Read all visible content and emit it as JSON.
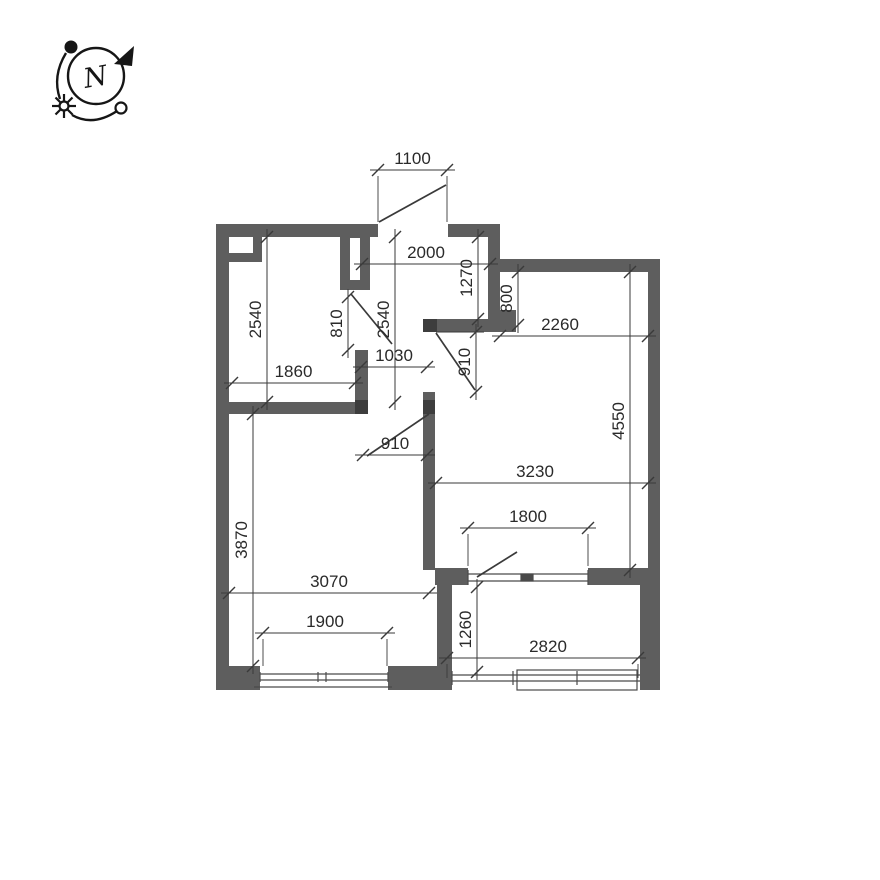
{
  "colors": {
    "background": "#ffffff",
    "wall": "#5e5e5e",
    "jamb": "#3d3d3d",
    "line": "#3a3a3a",
    "window_line": "#4a4a4a",
    "text": "#2a2a2a",
    "compass": "#161616"
  },
  "compass": {
    "label": "N"
  },
  "plan": {
    "walls": [
      {
        "x": 216,
        "y": 224,
        "w": 13,
        "h": 466
      },
      {
        "x": 216,
        "y": 224,
        "w": 162,
        "h": 13
      },
      {
        "x": 448,
        "y": 224,
        "w": 52,
        "h": 13
      },
      {
        "x": 488,
        "y": 237,
        "w": 12,
        "h": 88
      },
      {
        "x": 500,
        "y": 259,
        "w": 160,
        "h": 13
      },
      {
        "x": 648,
        "y": 259,
        "w": 12,
        "h": 431
      },
      {
        "x": 229,
        "y": 237,
        "w": 33,
        "h": 25
      },
      {
        "x": 340,
        "y": 237,
        "w": 30,
        "h": 53
      },
      {
        "x": 355,
        "y": 350,
        "w": 13,
        "h": 64
      },
      {
        "x": 216,
        "y": 402,
        "w": 152,
        "h": 12
      },
      {
        "x": 423,
        "y": 319,
        "w": 93,
        "h": 13
      },
      {
        "x": 500,
        "y": 310,
        "w": 16,
        "h": 9
      },
      {
        "x": 423,
        "y": 392,
        "w": 12,
        "h": 178
      },
      {
        "x": 435,
        "y": 568,
        "w": 33,
        "h": 17
      },
      {
        "x": 588,
        "y": 568,
        "w": 72,
        "h": 17
      },
      {
        "x": 437,
        "y": 585,
        "w": 15,
        "h": 93
      },
      {
        "x": 216,
        "y": 666,
        "w": 236,
        "h": 24
      },
      {
        "x": 640,
        "y": 585,
        "w": 20,
        "h": 105
      }
    ],
    "overlays": [
      {
        "x": 229,
        "y": 237,
        "w": 24,
        "h": 16
      },
      {
        "x": 350,
        "y": 238,
        "w": 10,
        "h": 42
      },
      {
        "x": 260,
        "y": 666,
        "w": 128,
        "h": 24
      }
    ],
    "jambs": [
      {
        "x": 355,
        "y": 400,
        "w": 13,
        "h": 14
      },
      {
        "x": 423,
        "y": 400,
        "w": 12,
        "h": 14
      },
      {
        "x": 423,
        "y": 319,
        "w": 14,
        "h": 13
      }
    ],
    "doors": [
      {
        "name": "entry-door-leaf",
        "line": [
          379,
          222,
          446,
          185
        ]
      },
      {
        "name": "bathroom-door-leaf",
        "line": [
          351,
          294,
          392,
          344
        ]
      },
      {
        "name": "living-room-door-leaf",
        "line": [
          436,
          333,
          475,
          390
        ]
      },
      {
        "name": "bedroom-door-leaf",
        "line": [
          367,
          456,
          429,
          414
        ]
      },
      {
        "name": "balcony-door-leaf",
        "line": [
          477,
          577,
          517,
          552
        ]
      }
    ],
    "windows": [
      {
        "name": "bedroom-window",
        "t": "l",
        "c": [
          260,
          674,
          388,
          674
        ]
      },
      {
        "name": "bedroom-window",
        "t": "l",
        "c": [
          260,
          680,
          388,
          680
        ]
      },
      {
        "name": "bedroom-window",
        "t": "l",
        "c": [
          260,
          672,
          260,
          682
        ]
      },
      {
        "name": "bedroom-window",
        "t": "l",
        "c": [
          388,
          672,
          388,
          682
        ]
      },
      {
        "name": "bedroom-window-mullion",
        "t": "l",
        "c": [
          318,
          672,
          318,
          682
        ]
      },
      {
        "name": "bedroom-window-mullion",
        "t": "l",
        "c": [
          326,
          672,
          326,
          682
        ]
      },
      {
        "name": "bedroom-window-sill",
        "t": "l",
        "c": [
          254,
          687,
          392,
          687
        ]
      },
      {
        "name": "balcony-glazing",
        "t": "l",
        "c": [
          452,
          675,
          640,
          675
        ]
      },
      {
        "name": "balcony-glazing",
        "t": "l",
        "c": [
          452,
          681,
          640,
          681
        ]
      },
      {
        "name": "balcony-glazing",
        "t": "l",
        "c": [
          452,
          671,
          452,
          685
        ]
      },
      {
        "name": "balcony-glazing-mullion",
        "t": "l",
        "c": [
          513,
          671,
          513,
          685
        ]
      },
      {
        "name": "balcony-glazing-mullion",
        "t": "l",
        "c": [
          577,
          671,
          577,
          685
        ]
      },
      {
        "name": "balcony-glazing-frame",
        "t": "r",
        "c": [
          517,
          670,
          120,
          20
        ]
      },
      {
        "name": "balcony-door-unit",
        "t": "l",
        "c": [
          468,
          574,
          588,
          574
        ]
      },
      {
        "name": "balcony-door-unit",
        "t": "l",
        "c": [
          468,
          581,
          588,
          581
        ]
      },
      {
        "name": "balcony-door-unit",
        "t": "l",
        "c": [
          468,
          570,
          468,
          585
        ]
      },
      {
        "name": "balcony-door-unit",
        "t": "l",
        "c": [
          588,
          570,
          588,
          585
        ]
      },
      {
        "name": "balcony-door-unit-mullion",
        "t": "r",
        "c": [
          521,
          574,
          12,
          7
        ],
        "f": true
      }
    ],
    "dims": [
      {
        "v": "1100",
        "d": "h",
        "a": 378,
        "b": 447,
        "p": 170,
        "ext": [
          [
            378,
            176,
            378,
            222
          ],
          [
            447,
            176,
            447,
            222
          ]
        ]
      },
      {
        "v": "2000",
        "d": "h",
        "a": 362,
        "b": 490,
        "p": 264
      },
      {
        "v": "2540",
        "d": "v",
        "a": 237,
        "b": 402,
        "p": 267
      },
      {
        "v": "1860",
        "d": "h",
        "a": 232,
        "b": 355,
        "p": 383
      },
      {
        "v": "810",
        "d": "v",
        "a": 297,
        "b": 350,
        "p": 348
      },
      {
        "v": "2540",
        "d": "v",
        "a": 237,
        "b": 402,
        "p": 395
      },
      {
        "v": "1030",
        "d": "h",
        "a": 361,
        "b": 427,
        "p": 367
      },
      {
        "v": "1270",
        "d": "v",
        "a": 237,
        "b": 319,
        "p": 478
      },
      {
        "v": "800",
        "d": "v",
        "a": 272,
        "b": 325,
        "p": 518
      },
      {
        "v": "2260",
        "d": "h",
        "a": 500,
        "b": 648,
        "p": 336,
        "tx": 560
      },
      {
        "v": "910",
        "d": "v",
        "a": 332,
        "b": 392,
        "p": 476,
        "ext": [
          [
            436,
            332,
            484,
            332
          ]
        ]
      },
      {
        "v": "4550",
        "d": "v",
        "a": 272,
        "b": 570,
        "p": 630
      },
      {
        "v": "3230",
        "d": "h",
        "a": 436,
        "b": 648,
        "p": 483,
        "tx": 535
      },
      {
        "v": "1800",
        "d": "h",
        "a": 468,
        "b": 588,
        "p": 528,
        "ext": [
          [
            468,
            534,
            468,
            566
          ],
          [
            588,
            534,
            588,
            566
          ]
        ]
      },
      {
        "v": "910",
        "d": "h",
        "a": 363,
        "b": 427,
        "p": 455
      },
      {
        "v": "3870",
        "d": "v",
        "a": 414,
        "b": 666,
        "p": 253
      },
      {
        "v": "3070",
        "d": "h",
        "a": 229,
        "b": 429,
        "p": 593
      },
      {
        "v": "1900",
        "d": "h",
        "a": 263,
        "b": 387,
        "p": 633,
        "ext": [
          [
            263,
            639,
            263,
            666
          ],
          [
            387,
            639,
            387,
            666
          ]
        ]
      },
      {
        "v": "1260",
        "d": "v",
        "a": 587,
        "b": 672,
        "p": 477
      },
      {
        "v": "2820",
        "d": "h",
        "a": 447,
        "b": 638,
        "p": 658,
        "tx": 548,
        "ext": [
          [
            447,
            664,
            447,
            678
          ],
          [
            638,
            664,
            638,
            678
          ]
        ]
      }
    ]
  }
}
